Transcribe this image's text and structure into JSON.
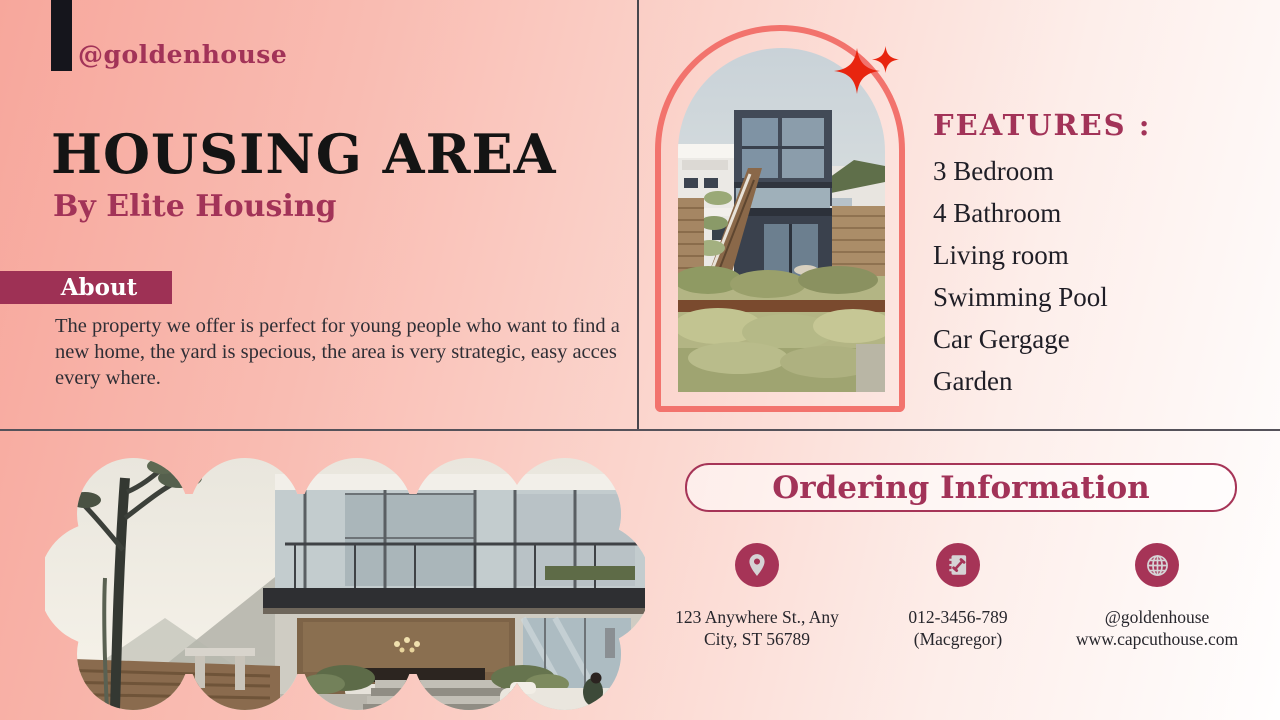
{
  "brand": {
    "handle": "@goldenhouse"
  },
  "hero": {
    "title": "HOUSING AREA",
    "subtitle": "By Elite Housing"
  },
  "about": {
    "label": "About",
    "body": "The property we offer is perfect for young people who want to find a new home, the yard is specious, the area is very strategic, easy acces every where."
  },
  "features": {
    "heading": "FEATURES :",
    "items": [
      "3 Bedroom",
      "4 Bathroom",
      "Living room",
      "Swimming Pool",
      "Car Gergage",
      "Garden"
    ]
  },
  "ordering": {
    "heading": "Ordering Information",
    "contacts": [
      {
        "icon": "location-pin-icon",
        "lines": [
          "123 Anywhere St., Any",
          "City, ST 56789"
        ]
      },
      {
        "icon": "contact-book-icon",
        "lines": [
          "012-3456-789",
          "(Macgregor)"
        ]
      },
      {
        "icon": "globe-icon",
        "lines": [
          "@goldenhouse",
          "www.capcuthouse.com"
        ]
      }
    ]
  },
  "colors": {
    "magenta": "#a23358",
    "magenta_dark": "#9e3155",
    "salmon_border": "#f2736d",
    "sparkle_red": "#e8250f",
    "title_black": "#141414",
    "body_text": "#2f2e35",
    "bg_left": "#f7a79c",
    "bg_right": "#fffefe",
    "logo_black": "#15151c",
    "icon_gray": "#d6d3d5"
  }
}
